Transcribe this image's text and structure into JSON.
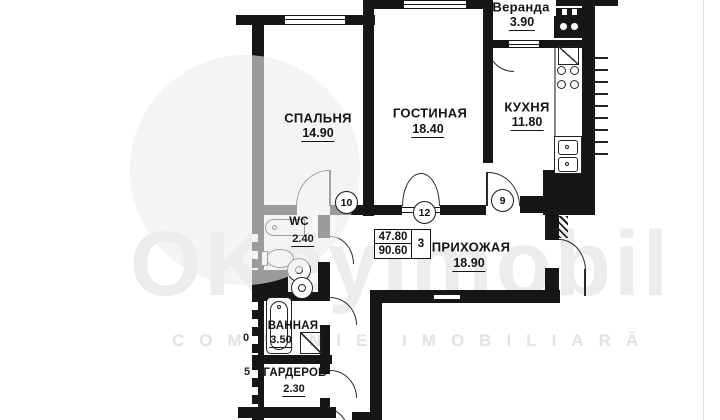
{
  "plan": {
    "type": "floor-plan",
    "rooms": [
      {
        "name": "СПАЛЬНЯ",
        "area": "14.90"
      },
      {
        "name": "ГОСТИНАЯ",
        "area": "18.40"
      },
      {
        "name": "Веранда",
        "area": "3.90"
      },
      {
        "name": "КУХНЯ",
        "area": "11.80"
      },
      {
        "name": "ПРИХОЖАЯ",
        "area": "18.90"
      },
      {
        "name": "WC",
        "area": "2.40"
      },
      {
        "name": "ВАННАЯ",
        "area": "3.50"
      },
      {
        "name": "ГАРДЕРОБ",
        "area": "2.30"
      }
    ],
    "summary_box": {
      "rooms_count": "3",
      "living_area": "47.80",
      "total_area": "90.60"
    },
    "door_numbers": {
      "bedroom": "10",
      "living_room": "12",
      "kitchen": "9"
    },
    "cut_off_labels": {
      "mid": "0",
      "low": "5"
    }
  },
  "watermark": {
    "brand": "OKeyImobil",
    "tagline": "COMPANIE IMOBILIARĂ"
  },
  "colors": {
    "wall": "#161616",
    "watermark_light": "#ececec"
  }
}
